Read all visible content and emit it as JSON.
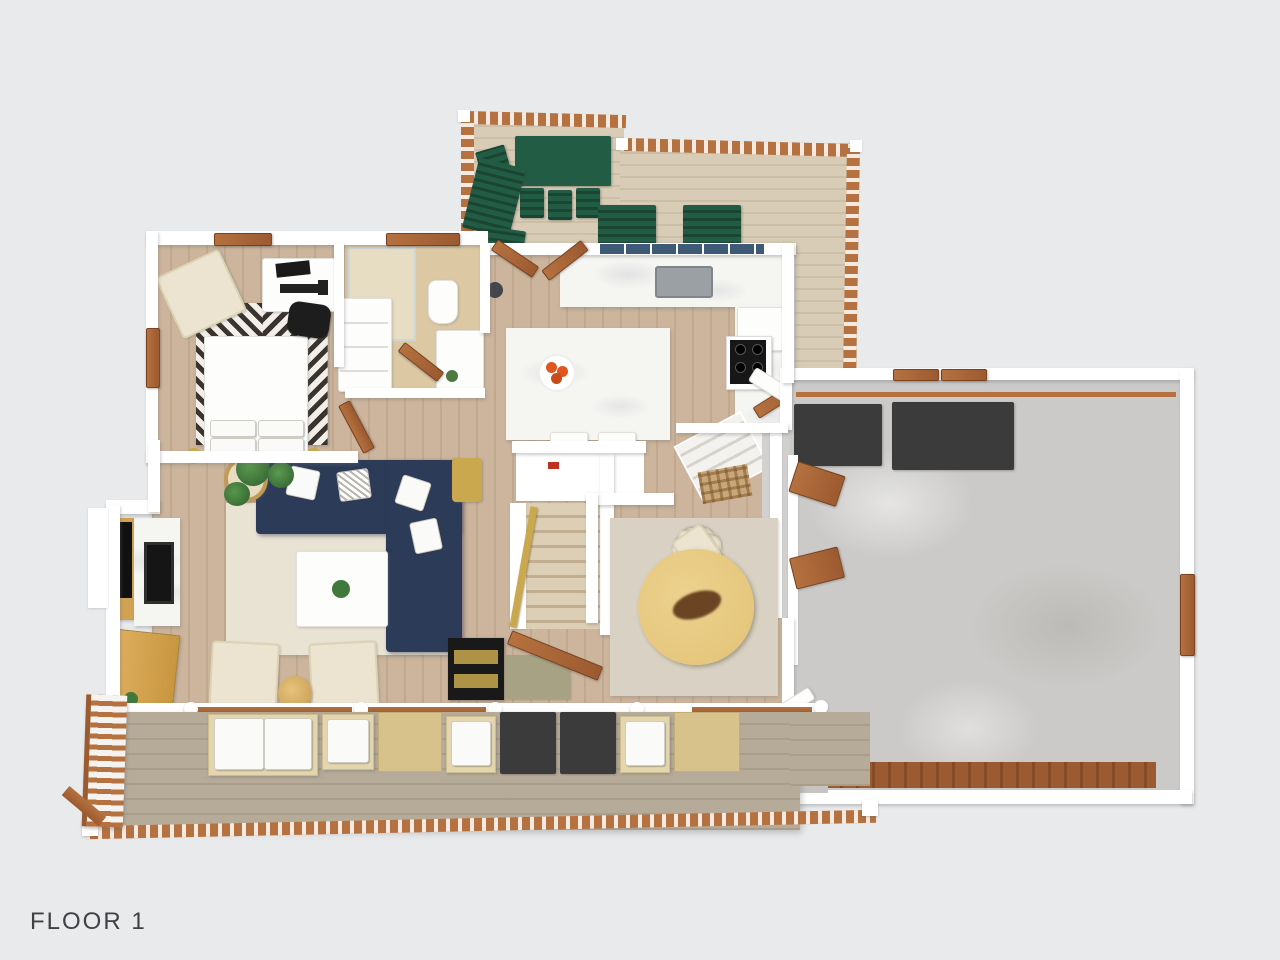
{
  "floor_label": {
    "text": "FLOOR 1"
  },
  "scene": {
    "kind": "3d-rendered-floor-plan",
    "view": "top-down",
    "regions": [
      "top-deck",
      "kitchen",
      "hallway",
      "bedroom",
      "closet",
      "bathroom",
      "living-room",
      "stairs-down",
      "stairs-up",
      "mudroom",
      "dining-room",
      "garage",
      "rear-deck"
    ],
    "furniture": [
      "green-patio-table",
      "green-patio-chairs",
      "green-loungers",
      "kitchen-island",
      "fruit-bowl",
      "sink",
      "range-cooktop",
      "fridge",
      "desk",
      "desk-chair",
      "laptop",
      "bed",
      "pillows",
      "chevron-rug",
      "armchair",
      "shower",
      "toilet",
      "vanity",
      "sectional-sofa-navy",
      "coffee-table",
      "tv",
      "fireplace",
      "media-cabinet",
      "cream-armchairs",
      "side-table",
      "round-dining-table",
      "dining-chairs",
      "door-mats",
      "garage-mats",
      "storage-benches",
      "outdoor-sofa",
      "outdoor-chairs",
      "outdoor-ottomans"
    ]
  },
  "colors": {
    "bg": "#e8eaec",
    "wall": "#ffffff",
    "wood": "#ccb59c",
    "decktop": "#d8ccb6",
    "deckbot": "#b6ab99",
    "rail": "#b5713f",
    "raildark": "#9c5a30",
    "green": "#235c44",
    "navy": "#2c3b58",
    "cream": "#ece4d0",
    "ruglv": "#e9e3d4",
    "rugdn": "#d9d2c4",
    "marble": "#f5f5f2",
    "concrete": "#cbcac8",
    "matdark": "#3b3b3b",
    "tablewood": "#e3c276",
    "gold": "#c9a84e",
    "tile": "#dcc9a4",
    "orange": "#e0561e",
    "black": "#1a1a1a",
    "text": "#3f4245",
    "olive": "#a8a285",
    "tanmat": "#d8c28c",
    "cabwood": "#d2a254",
    "bluewin": "#3e5a77",
    "chevron": "#3a332f"
  }
}
